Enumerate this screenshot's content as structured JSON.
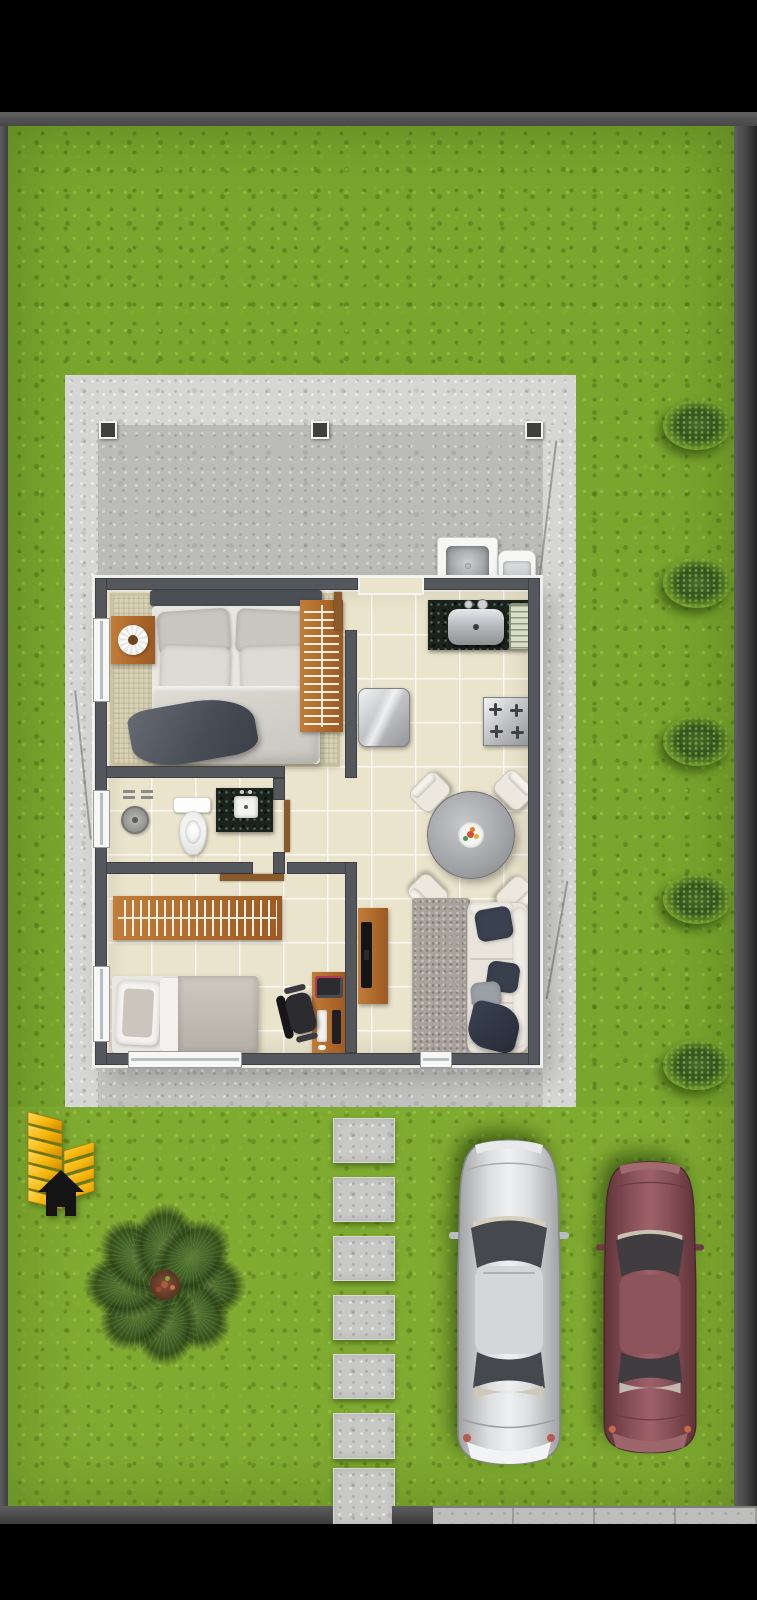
{
  "scene": {
    "type": "architectural-floor-plan-render",
    "view": "top-down",
    "setting": "single-storey house on a fenced grass lot with patio, walkway and two parked cars",
    "letterbox_bars": [
      "top",
      "bottom"
    ]
  },
  "house": {
    "label": "House floor plan",
    "rooms": [
      {
        "id": "bedroom-1",
        "label": "Bedroom 1 (double)",
        "furniture": [
          "double-bed",
          "headboard",
          "pillows x4",
          "duvet",
          "dark-throw-blanket",
          "nightstand",
          "round-tray",
          "wardrobe-with-hangers",
          "area-rug"
        ]
      },
      {
        "id": "bathroom",
        "label": "Bathroom",
        "furniture": [
          "shower-head",
          "shower-taps",
          "toilet",
          "granite-vanity",
          "square-sink",
          "door"
        ]
      },
      {
        "id": "bedroom-2",
        "label": "Bedroom 2 (single)",
        "furniture": [
          "single-bed",
          "pillow",
          "blanket",
          "wardrobe-with-hangers",
          "desk",
          "monitor",
          "keyboard",
          "mouse",
          "printer",
          "office-chair",
          "door"
        ]
      },
      {
        "id": "kitchen-dining-living",
        "label": "Kitchen / dining / living (open plan)",
        "furniture": [
          "granite-counter",
          "round-steel-sink",
          "dish-rack",
          "refrigerator",
          "cooktop-4-burners",
          "round-dining-table",
          "dining-chairs x4",
          "fruit-plate",
          "tv-rack",
          "tv",
          "gray-rug",
          "sofa",
          "cushions x3",
          "dark-throw"
        ]
      }
    ],
    "openings": {
      "entry_door": "kitchen rear door to patio",
      "window_count": 5
    },
    "patio": {
      "label": "Concrete patio / carport slab",
      "post_count": 3,
      "laundry": [
        "laundry-sink",
        "washing-tub"
      ]
    }
  },
  "yard": {
    "lawn": "grass",
    "bushes": {
      "count": 5,
      "position": "right edge"
    },
    "palm_tree": {
      "count": 1,
      "position": "front-left"
    },
    "stepping_stones": {
      "count": 7,
      "position": "center walkway to sidewalk"
    },
    "cars": [
      {
        "id": "car-silver",
        "label": "silver sedan",
        "color": "#c9cacc"
      },
      {
        "id": "car-maroon",
        "label": "maroon sedan",
        "color": "#8a5158"
      }
    ],
    "builder_logo": {
      "description": "gold chevron wheat emblem with black house silhouette",
      "gold": "#f6b80e",
      "black": "#141414"
    },
    "sidewalk": {
      "position": "bottom-right"
    }
  },
  "colors": {
    "background": "#000000",
    "boundary_wall": "#4f4f4f",
    "grass": "#7aa62e",
    "grass_dark": "#5e8a1f",
    "bush_green": "#33511f",
    "palm_green": "#3d5c24",
    "concrete": "#c8c8c6",
    "concrete_light": "#d6d6d4",
    "wall": "#54575b",
    "floor_tile": "#eae4cc",
    "granite": "#1b241c",
    "wood": "#b06f2e",
    "wood_dark": "#8a5a2b",
    "steel": "#b9bbbe",
    "linen": "#e9e7e1",
    "blanket_dark": "#565b64",
    "sofa_cream": "#e8e4db",
    "cushion_navy": "#3a4150",
    "rug_gray": "#a8a29b",
    "rug_beige": "#d7d1b5",
    "table_gray": "#a9abae",
    "car_silver": "#c9cacc",
    "car_maroon": "#8a5158",
    "logo_gold": "#f6b80e",
    "logo_black": "#141414",
    "sidewalk": "#bdbdbb"
  }
}
